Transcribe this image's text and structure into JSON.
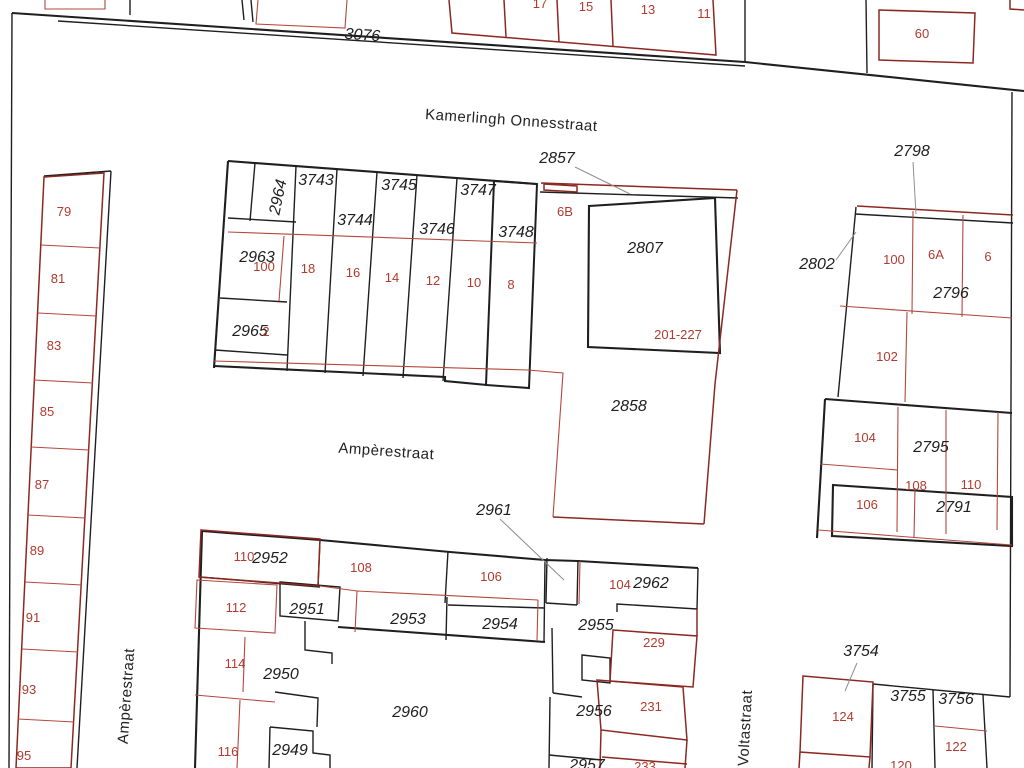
{
  "map": {
    "highlight_fill": "#64cbe8",
    "streets": [
      "Kamerlingh Onnesstraat",
      "Ampèrestraat",
      "Ampèrestraat",
      "Voltastraat"
    ],
    "parcels": [
      "3076",
      "2857",
      "2798",
      "2964",
      "3743",
      "3744",
      "3745",
      "3746",
      "3747",
      "3748",
      "2963",
      "2965",
      "2807",
      "2802",
      "2796",
      "2858",
      "2795",
      "2791",
      "2961",
      "2952",
      "2951",
      "2953",
      "2954",
      "2955",
      "2962",
      "2950",
      "2960",
      "2949",
      "2956",
      "2957",
      "3754",
      "3755",
      "3756"
    ],
    "houses": [
      "17",
      "15",
      "13",
      "11",
      "60",
      "79",
      "81",
      "83",
      "85",
      "87",
      "89",
      "91",
      "93",
      "95",
      "100",
      "2",
      "18",
      "16",
      "14",
      "12",
      "10",
      "8",
      "6B",
      "201-227",
      "100",
      "6A",
      "6",
      "102",
      "104",
      "108",
      "110",
      "106",
      "110",
      "108",
      "106",
      "104",
      "112",
      "114",
      "116",
      "229",
      "231",
      "233",
      "124",
      "122",
      "120"
    ]
  }
}
